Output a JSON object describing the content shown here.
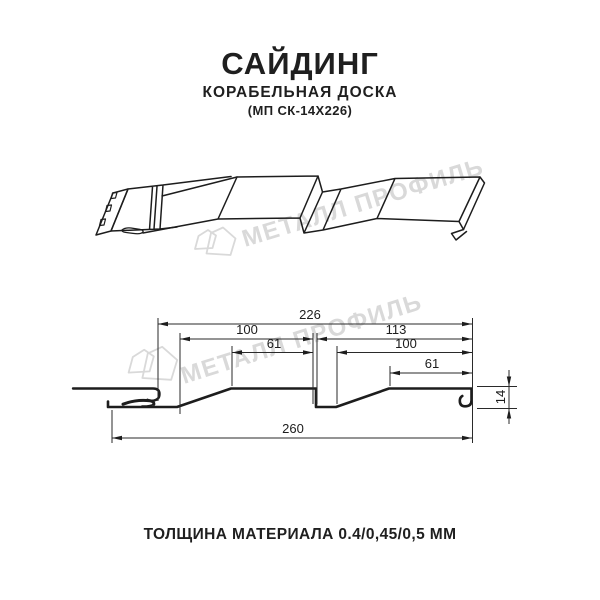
{
  "header": {
    "title": "САЙДИНГ",
    "subtitle": "КОРАБЕЛЬНАЯ ДОСКА",
    "model": "(МП СК-14Х226)"
  },
  "watermark": {
    "brand": "МЕТАЛЛ ПРОФИЛЬ",
    "color": "#d9d9d9"
  },
  "drawing": {
    "line_color": "#1d1d1d",
    "dimensions": {
      "panel_total": "226",
      "left_section": "100",
      "right_section": "113",
      "left_flat": "61",
      "right_inner": "100",
      "right_flat": "61",
      "overall_width": "260",
      "profile_height": "14"
    }
  },
  "footer": {
    "thickness_note": "ТОЛЩИНА МАТЕРИАЛА 0.4/0,45/0,5 ММ"
  }
}
